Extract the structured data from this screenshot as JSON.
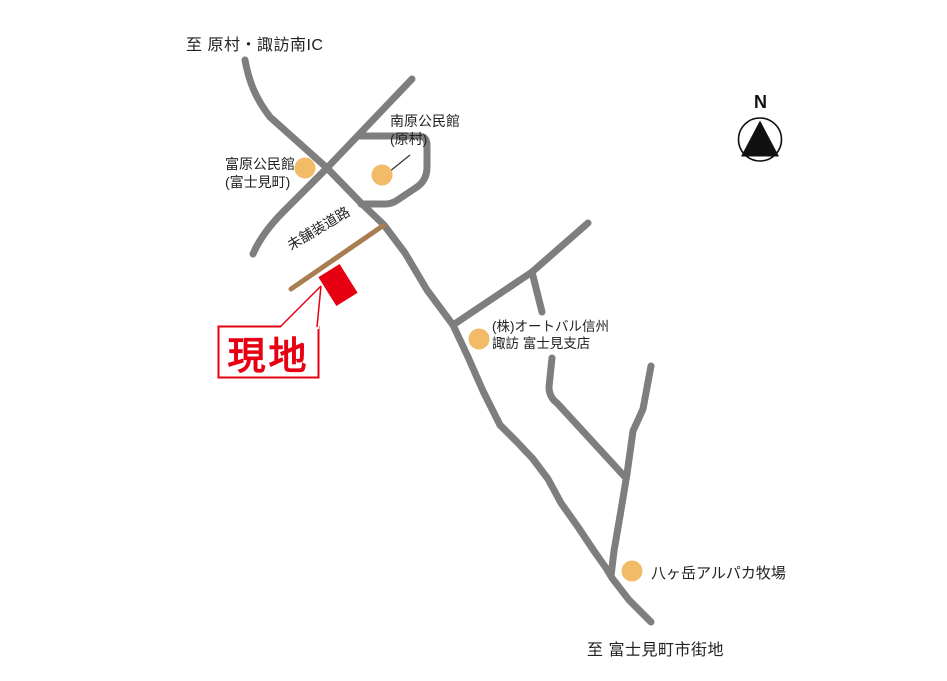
{
  "map_type": "access-map",
  "destinations": {
    "top": "至 原村・諏訪南IC",
    "bottom": "至 富士見町市街地"
  },
  "site": {
    "label": "現地",
    "marker_shape": "red rotated rectangle beside unpaved road"
  },
  "roads": {
    "unpaved_label": "未舗装道路"
  },
  "compass": {
    "north": "N"
  },
  "landmarks": [
    {
      "name": "南原公民館",
      "subname": "(原村)"
    },
    {
      "name": "富原公民館",
      "subname": "(富士見町)"
    },
    {
      "name": "(株)オートバル信州",
      "subname": "諏訪 富士見支店"
    },
    {
      "name": "八ヶ岳アルパカ牧場"
    }
  ],
  "colors": {
    "road_gray": "#7e7e7e",
    "unpaved_brown": "#a87e50",
    "landmark_orange": "#f2bb68",
    "site_red": "#e60012",
    "text_black": "#222222"
  }
}
